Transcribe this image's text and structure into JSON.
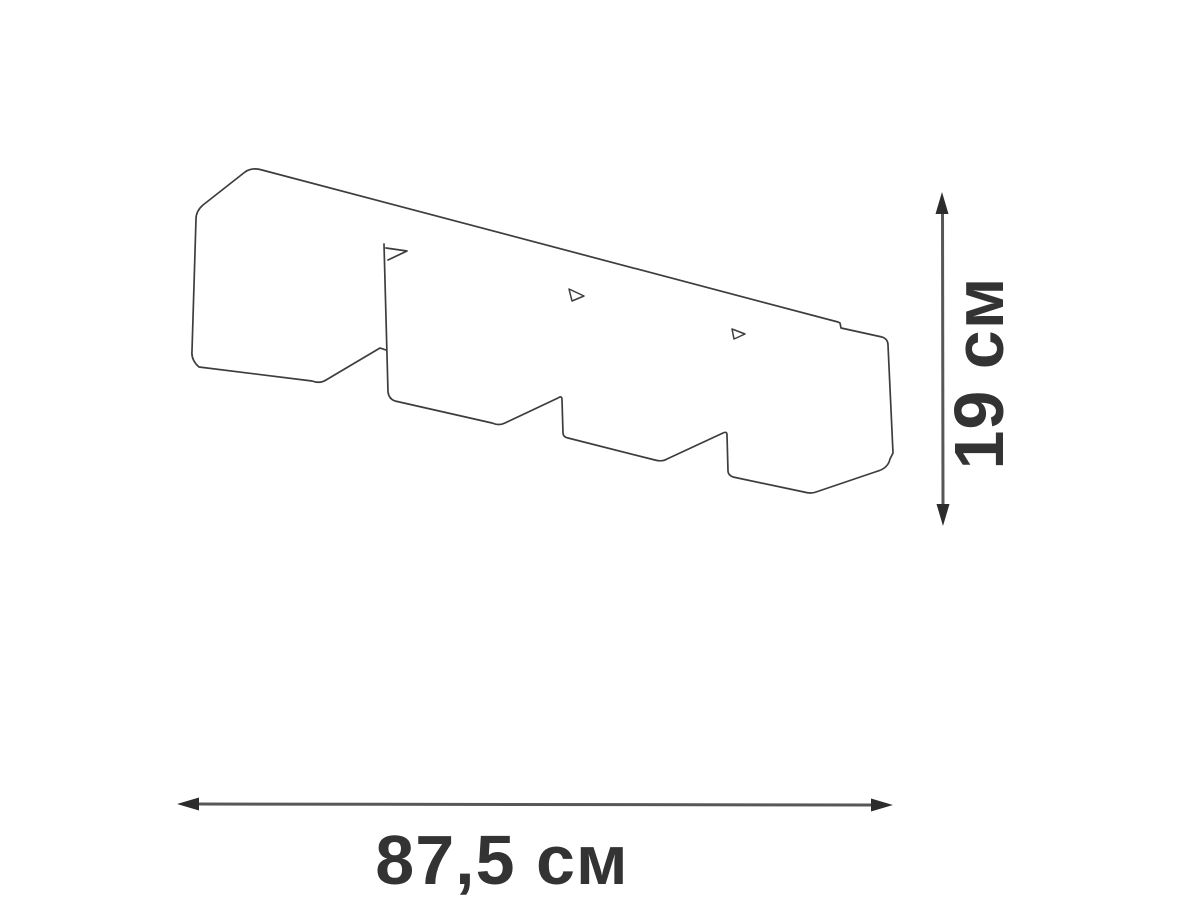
{
  "diagram": {
    "width_label": "87,5 см",
    "height_label": "19 см"
  },
  "colors": {
    "background": "#ffffff",
    "outline": "#3d3d3d",
    "dimension_line": "#575757",
    "arrowhead": "#2c2c2c",
    "label_text": "#333333"
  },
  "drawing": {
    "outline_path": "M 384 244 L 388 392 Q 389 399 395 401 L 492 423 Q 499 426 505 423 L 558 398 Q 562 395 562 400 L 563 433 Q 563 437 568 438 L 655 460 Q 662 462 667 459 L 723 433 Q 727 431 727 435 L 728 471 Q 728 475 733 477 L 804 492 Q 811 494 816 492 L 878 471 Q 888 468 890 459 L 893 453 L 888 345 Q 888 339 882 337 L 841 328 L 840 323 L 838 322 L 262 170 Q 252 167 245 172 L 203 205 Q 196 211 196 219 L 192 351 Q 191 360 199 367 L 312 381 Q 320 384 326 380 L 380 348 L 386 350",
    "mounting_tab_path": "M 386 248 L 407 251 L 388 260",
    "clip_mark_1_path": "M 569 289 L 584 296 L 572 301 Z",
    "clip_mark_2_path": "M 732 329 L 745 334 L 734 339 Z",
    "height_arrow": {
      "line": "M 942.5 211 L 943 507",
      "head_top": "M 942 192 L 935.5 214 L 948.5 214 Z",
      "head_bottom": "M 943 526 L 936.5 504 L 949.5 504 Z"
    },
    "width_arrow": {
      "line": "M 197 804 L 873 805",
      "head_left": "M 177 804 L 199 797.5 L 199 810.5 Z",
      "head_right": "M 893 805 L 871 798.5 L 871 811.5 Z"
    }
  }
}
